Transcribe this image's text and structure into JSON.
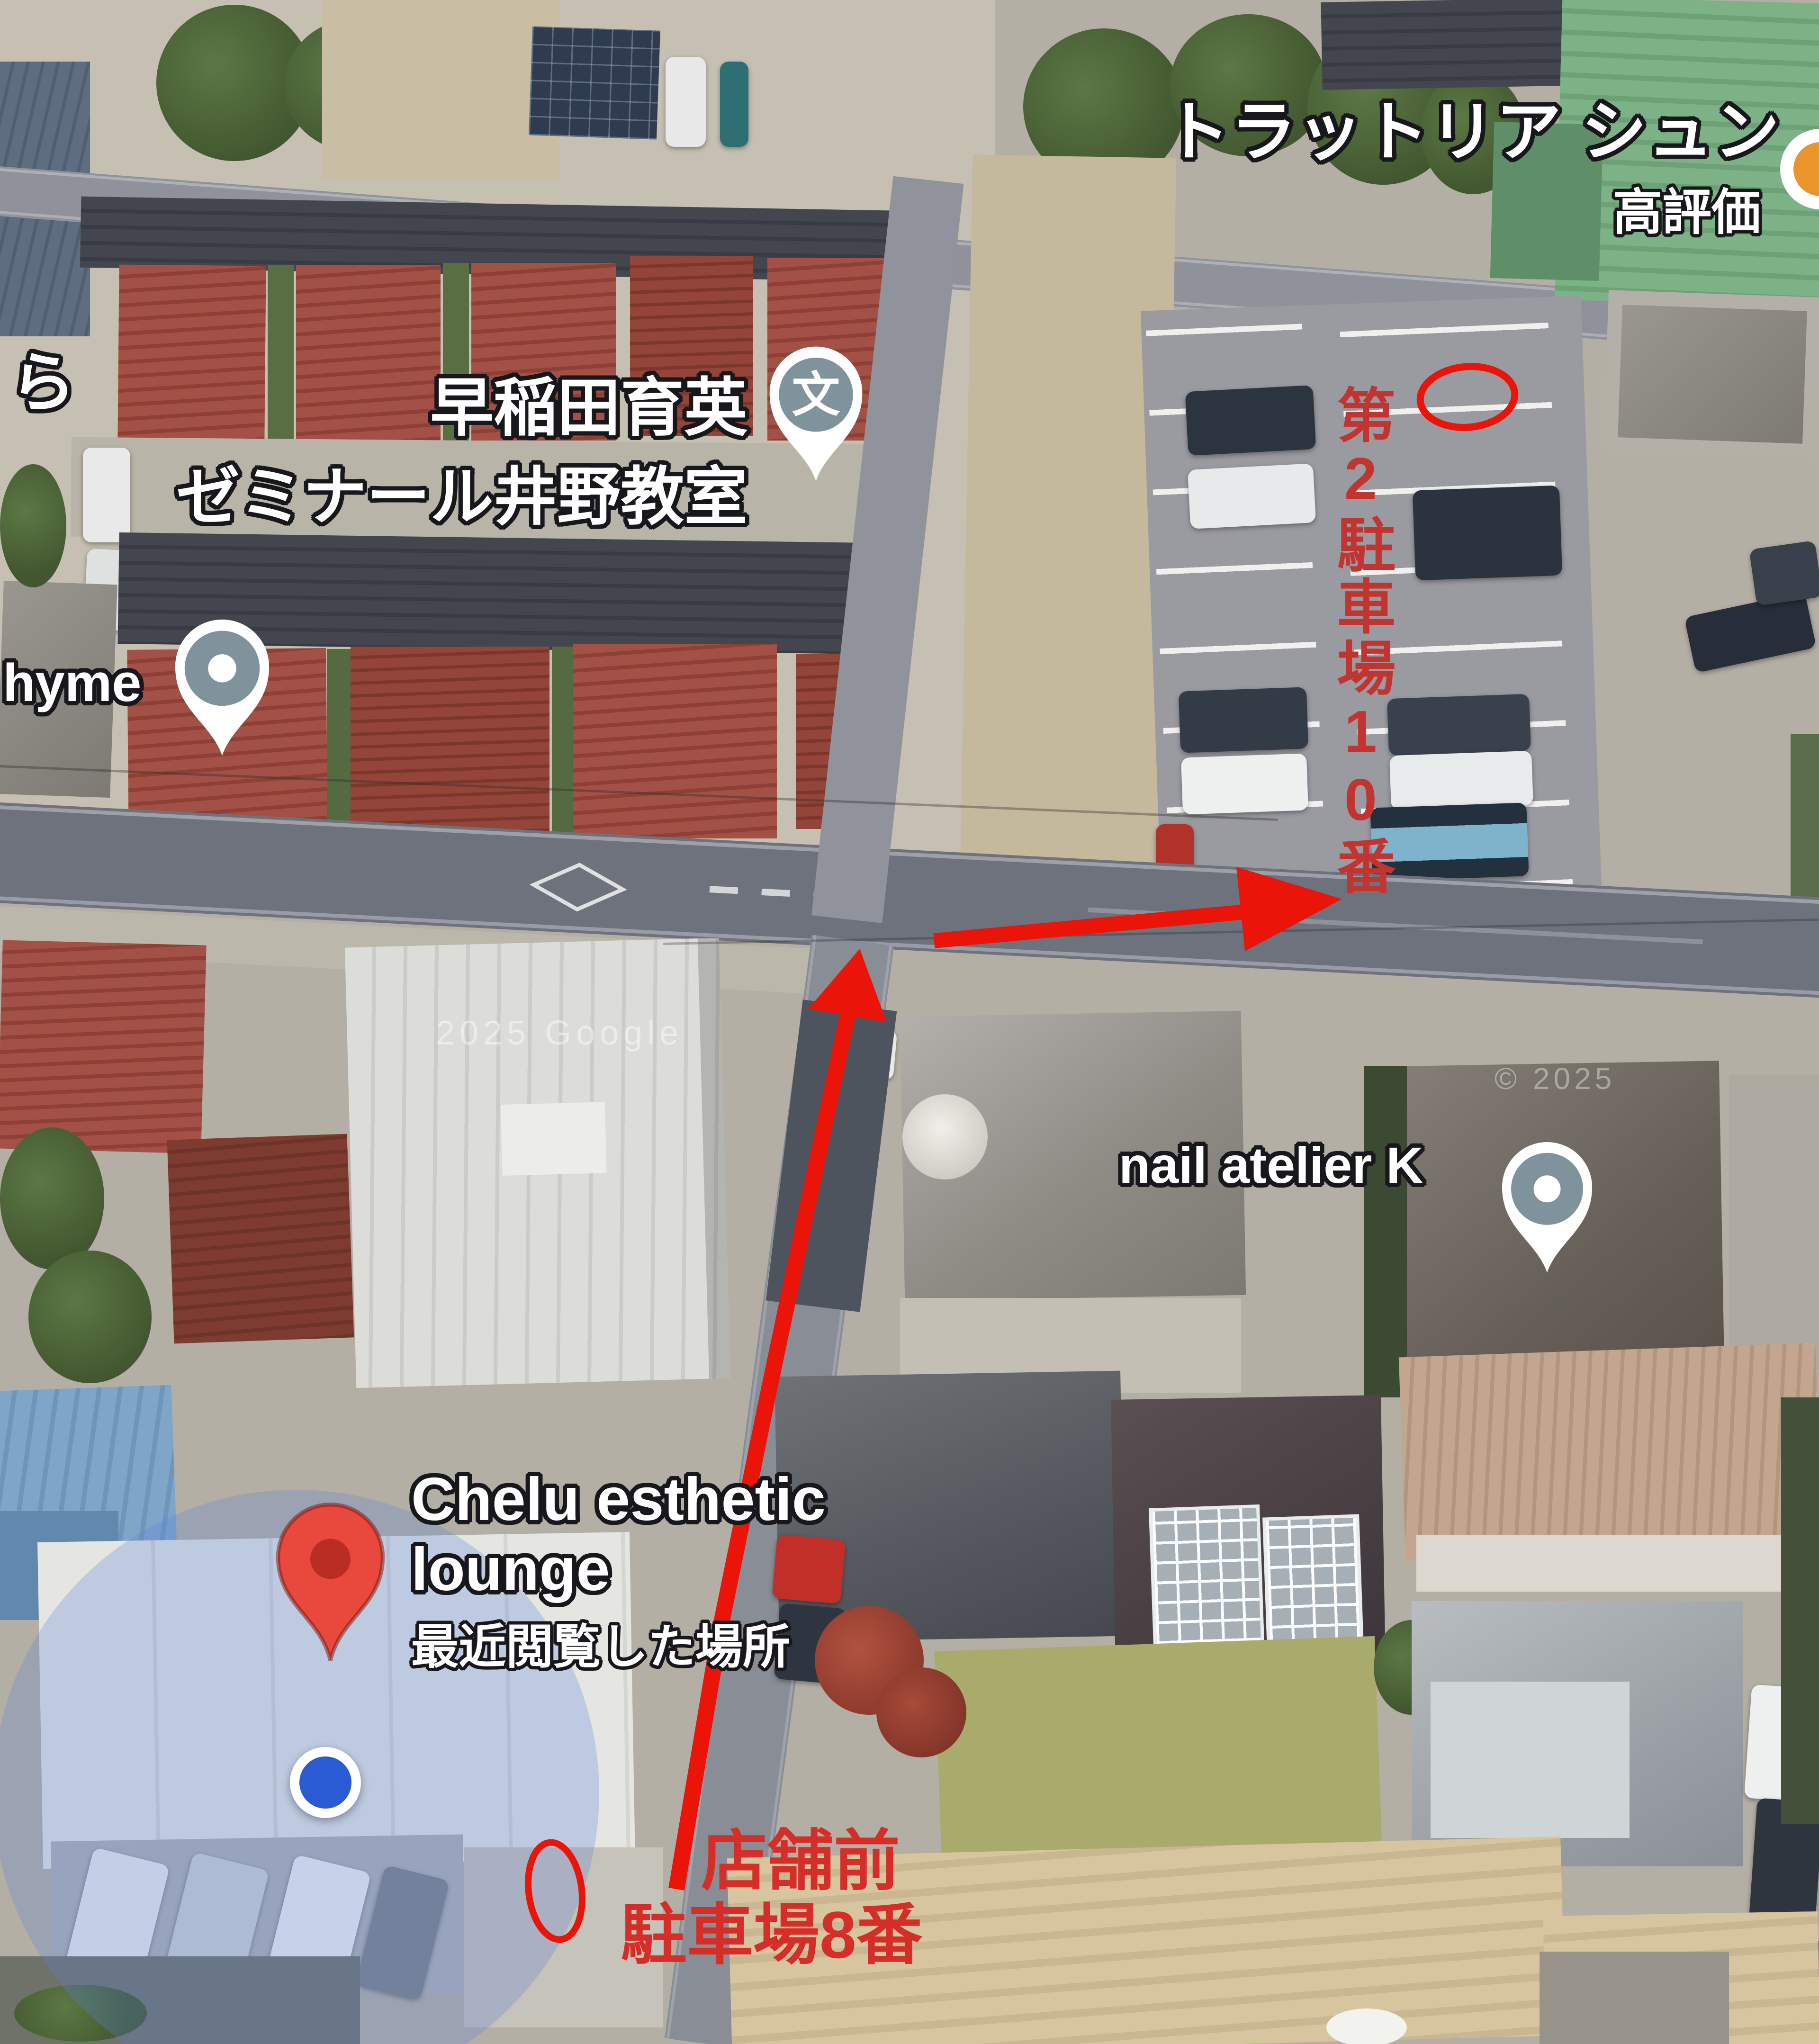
{
  "colors": {
    "annotation_red": "#ea1408",
    "parking_label_red": "#c23430",
    "store_label_red": "#d52e28",
    "label_outline": "#17171c",
    "pin_red_fill": "#e8493c",
    "pin_red_inner": "#ba2d24",
    "pin_slate_fill": "#7e939c",
    "location_dot_blue": "#2a5ad4",
    "accuracy_circle_blue": "#5b82d8",
    "poi_orange": "#e9952c"
  },
  "labels": {
    "restaurant": {
      "name": "トラットリア シュン",
      "badge": "高評価"
    },
    "school": {
      "line1": "早稲田育英",
      "line2": "ゼミナール井野教室",
      "icon_glyph": "文"
    },
    "left_partial": "ら",
    "shop_partial": "hyme",
    "nail_salon": "nail atelier K",
    "chelu": {
      "line1": "Chelu esthetic",
      "line2": "lounge",
      "note": "最近閲覧した場所"
    },
    "parking_lot2_vertical": "第2駐車場10番",
    "store_front": {
      "line1": "店舗前",
      "line2": "駐車場8番"
    },
    "watermark_center": "2025 Google",
    "watermark_right": "© 2025"
  },
  "annotations": {
    "shapes": [
      "red-circle-parking-lot2-stall",
      "red-oval-store-front-stall",
      "red-arrow-up-road",
      "red-arrow-right-to-parking"
    ]
  },
  "pins": [
    {
      "id": "school-pin",
      "kind": "education"
    },
    {
      "id": "thyme-pin",
      "kind": "place"
    },
    {
      "id": "nail-atelier-pin",
      "kind": "place"
    },
    {
      "id": "chelu-red-pin",
      "kind": "saved-place"
    },
    {
      "id": "restaurant-orange-poi",
      "kind": "restaurant"
    },
    {
      "id": "current-location-dot",
      "kind": "my-location"
    }
  ]
}
